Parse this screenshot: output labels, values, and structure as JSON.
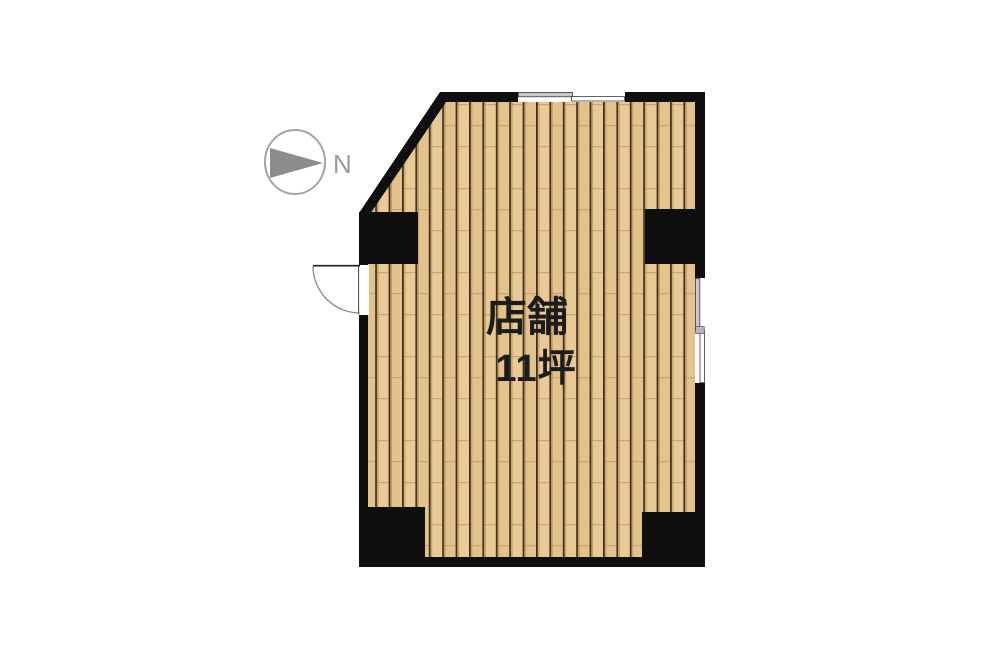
{
  "floorplan": {
    "room": {
      "label": "店舗",
      "area": "11坪"
    },
    "compass": {
      "label": "N"
    },
    "colors": {
      "wall": "#0f0f0f",
      "floor_base": "#e9ca97",
      "floor_base_alt": "#e4c28b",
      "plank_line": "#402f1e",
      "plank_joint": "#caa36e",
      "window_sash_gray": "#c9c9c9",
      "compass_gray": "#8c8c8c",
      "text": "#1c1c1c",
      "background": "#ffffff"
    }
  }
}
